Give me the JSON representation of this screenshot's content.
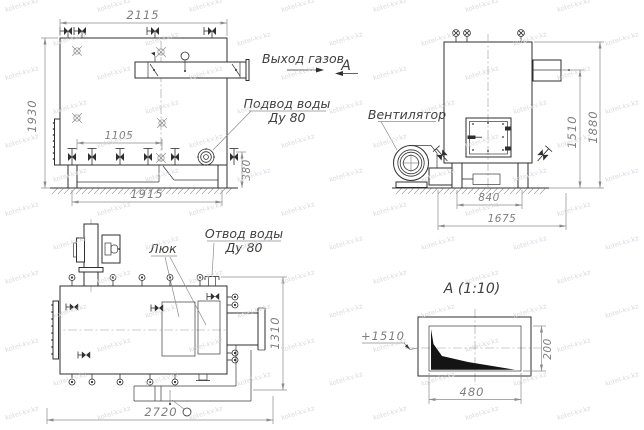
{
  "watermark": {
    "text": "kotel-kv.kz",
    "color": "#ccd2d8"
  },
  "colors": {
    "line": "#2f2f2f",
    "dim": "#8c8c8c",
    "background": "#ffffff",
    "fill_dark": "#141414"
  },
  "side_view": {
    "dim_top_width": "2115",
    "dim_height": "1930",
    "dim_valve_span": "1105",
    "dim_base_length": "1915",
    "dim_base_height": "380",
    "gas_outlet_label": "Выход газов",
    "water_supply_label_line1": "Подвод воды",
    "water_supply_label_line2": "Ду 80"
  },
  "front_view": {
    "fan_label": "Вентилятор",
    "section_arrow_label": "A",
    "dim_height_outlet": "1510",
    "dim_height_overall": "1880",
    "dim_leg_span": "840",
    "dim_overall_length": "1675"
  },
  "plan_view": {
    "hatch_label": "Люк",
    "water_drain_label_line1": "Отвод воды",
    "water_drain_label_line2": "Ду 80",
    "dim_overall_length": "2720",
    "dim_overall_width": "1310"
  },
  "section_view": {
    "title": "A (1:10)",
    "elevation_mark": "+1510",
    "dim_width": "480",
    "dim_height": "200"
  }
}
